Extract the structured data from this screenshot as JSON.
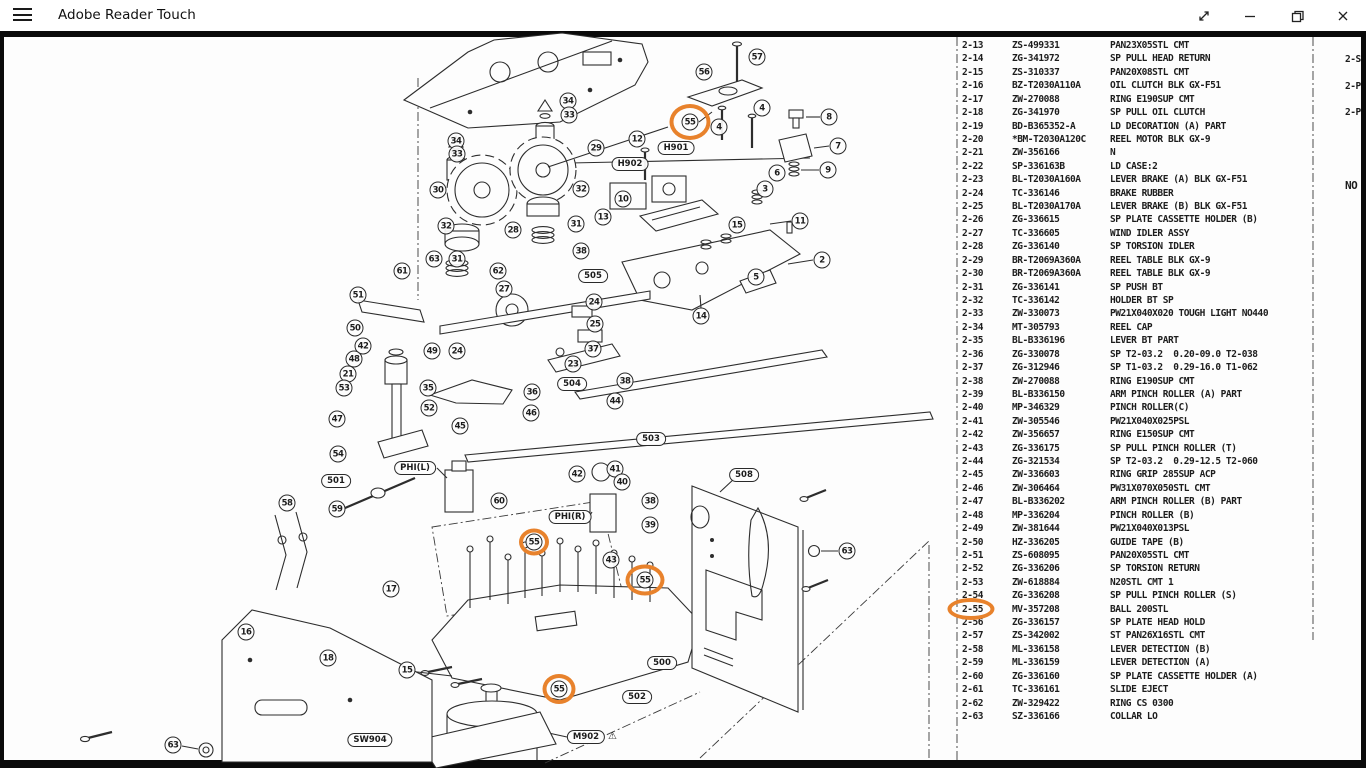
{
  "window": {
    "title": "Adobe Reader Touch"
  },
  "titlebar": {
    "controls": [
      "menu",
      "fullscreen",
      "minimize",
      "restore",
      "close"
    ]
  },
  "page": {
    "parts_list": {
      "layout": {
        "left_x": 962,
        "top_y": 46,
        "row_height": 13.42,
        "ref_dx": 0,
        "part_dx": 50,
        "desc_dx": 148
      },
      "partial_top_row": {
        "ref": "2-12",
        "part": "ZS-366165",
        "desc": "SP PAN26X05STL CMT",
        "y": 33
      },
      "rows": [
        {
          "ref": "2-13",
          "part": "ZS-499331",
          "desc": "PAN23X05STL CMT"
        },
        {
          "ref": "2-14",
          "part": "ZG-341972",
          "desc": "SP PULL HEAD RETURN"
        },
        {
          "ref": "2-15",
          "part": "ZS-310337",
          "desc": "PAN20X08STL CMT"
        },
        {
          "ref": "2-16",
          "part": "BZ-T2030A110A",
          "desc": "OIL CLUTCH BLK GX-F51"
        },
        {
          "ref": "2-17",
          "part": "ZW-270088",
          "desc": "RING E190SUP CMT"
        },
        {
          "ref": "2-18",
          "part": "ZG-341970",
          "desc": "SP PULL OIL CLUTCH"
        },
        {
          "ref": "2-19",
          "part": "BD-B365352-A",
          "desc": "LD DECORATION (A) PART"
        },
        {
          "ref": "2-20",
          "part": "*BM-T2030A120C",
          "desc": "REEL MOTOR BLK GX-9"
        },
        {
          "ref": "2-21",
          "part": "ZW-356166",
          "desc": "N"
        },
        {
          "ref": "2-22",
          "part": "SP-336163B",
          "desc": "LD CASE:2"
        },
        {
          "ref": "2-23",
          "part": "BL-T2030A160A",
          "desc": "LEVER BRAKE (A) BLK GX-F51"
        },
        {
          "ref": "2-24",
          "part": "TC-336146",
          "desc": "BRAKE RUBBER"
        },
        {
          "ref": "2-25",
          "part": "BL-T2030A170A",
          "desc": "LEVER BRAKE (B) BLK GX-F51"
        },
        {
          "ref": "2-26",
          "part": "ZG-336615",
          "desc": "SP PLATE CASSETTE HOLDER (B)"
        },
        {
          "ref": "2-27",
          "part": "TC-336605",
          "desc": "WIND IDLER ASSY"
        },
        {
          "ref": "2-28",
          "part": "ZG-336140",
          "desc": "SP TORSION IDLER"
        },
        {
          "ref": "2-29",
          "part": "BR-T2069A360A",
          "desc": "REEL TABLE BLK GX-9"
        },
        {
          "ref": "2-30",
          "part": "BR-T2069A360A",
          "desc": "REEL TABLE BLK GX-9"
        },
        {
          "ref": "2-31",
          "part": "ZG-336141",
          "desc": "SP PUSH BT"
        },
        {
          "ref": "2-32",
          "part": "TC-336142",
          "desc": "HOLDER BT SP"
        },
        {
          "ref": "2-33",
          "part": "ZW-330073",
          "desc": "PW21X040X020 TOUGH LIGHT NO440"
        },
        {
          "ref": "2-34",
          "part": "MT-305793",
          "desc": "REEL CAP"
        },
        {
          "ref": "2-35",
          "part": "BL-B336196",
          "desc": "LEVER BT PART"
        },
        {
          "ref": "2-36",
          "part": "ZG-330078",
          "desc": "SP T2-03.2  0.20-09.0 T2-038"
        },
        {
          "ref": "2-37",
          "part": "ZG-312946",
          "desc": "SP T1-03.2  0.29-16.0 T1-062"
        },
        {
          "ref": "2-38",
          "part": "ZW-270088",
          "desc": "RING E190SUP CMT"
        },
        {
          "ref": "2-39",
          "part": "BL-B336150",
          "desc": "ARM PINCH ROLLER (A) PART"
        },
        {
          "ref": "2-40",
          "part": "MP-346329",
          "desc": "PINCH ROLLER(C)"
        },
        {
          "ref": "2-41",
          "part": "ZW-305546",
          "desc": "PW21X040X025PSL"
        },
        {
          "ref": "2-42",
          "part": "ZW-356657",
          "desc": "RING E150SUP CMT"
        },
        {
          "ref": "2-43",
          "part": "ZG-336175",
          "desc": "SP PULL PINCH ROLLER (T)"
        },
        {
          "ref": "2-44",
          "part": "ZG-321534",
          "desc": "SP T2-03.2  0.29-12.5 T2-060"
        },
        {
          "ref": "2-45",
          "part": "ZW-336603",
          "desc": "RING GRIP 285SUP ACP"
        },
        {
          "ref": "2-46",
          "part": "ZW-306464",
          "desc": "PW31X070X050STL CMT"
        },
        {
          "ref": "2-47",
          "part": "BL-B336202",
          "desc": "ARM PINCH ROLLER (B) PART"
        },
        {
          "ref": "2-48",
          "part": "MP-336204",
          "desc": "PINCH ROLLER (B)"
        },
        {
          "ref": "2-49",
          "part": "ZW-381644",
          "desc": "PW21X040X013PSL"
        },
        {
          "ref": "2-50",
          "part": "HZ-336205",
          "desc": "GUIDE TAPE (B)"
        },
        {
          "ref": "2-51",
          "part": "ZS-608095",
          "desc": "PAN20X05STL CMT"
        },
        {
          "ref": "2-52",
          "part": "ZG-336206",
          "desc": "SP TORSION RETURN"
        },
        {
          "ref": "2-53",
          "part": "ZW-618884",
          "desc": "N20STL CMT 1"
        },
        {
          "ref": "2-54",
          "part": "ZG-336208",
          "desc": "SP PULL PINCH ROLLER (S)"
        },
        {
          "ref": "2-55",
          "part": "MV-357208",
          "desc": "BALL 200STL"
        },
        {
          "ref": "2-56",
          "part": "ZG-336157",
          "desc": "SP PLATE HEAD HOLD"
        },
        {
          "ref": "2-57",
          "part": "ZS-342002",
          "desc": "ST PAN26X16STL CMT"
        },
        {
          "ref": "2-58",
          "part": "ML-336158",
          "desc": "LEVER DETECTION (B)"
        },
        {
          "ref": "2-59",
          "part": "ML-336159",
          "desc": "LEVER DETECTION (A)"
        },
        {
          "ref": "2-60",
          "part": "ZG-336160",
          "desc": "SP PLATE CASSETTE HOLDER (A)"
        },
        {
          "ref": "2-61",
          "part": "TC-336161",
          "desc": "SLIDE EJECT"
        },
        {
          "ref": "2-62",
          "part": "ZW-329422",
          "desc": "RING CS 0300"
        },
        {
          "ref": "2-63",
          "part": "SZ-336166",
          "desc": "COLLAR LO"
        }
      ],
      "side_fragments": [
        {
          "text": "2-S",
          "x": 1345,
          "y": 60
        },
        {
          "text": "2-P",
          "x": 1345,
          "y": 87
        },
        {
          "text": "2-P",
          "x": 1345,
          "y": 113
        },
        {
          "text": "NO",
          "x": 1345,
          "y": 185
        }
      ]
    },
    "diagram": {
      "callouts": [
        {
          "n": "57",
          "x": 757,
          "y": 57
        },
        {
          "n": "56",
          "x": 704,
          "y": 72
        },
        {
          "n": "55",
          "x": 690,
          "y": 122
        },
        {
          "n": "4",
          "x": 762,
          "y": 108
        },
        {
          "n": "4",
          "x": 719,
          "y": 127
        },
        {
          "n": "8",
          "x": 829,
          "y": 117
        },
        {
          "n": "7",
          "x": 838,
          "y": 146
        },
        {
          "n": "9",
          "x": 828,
          "y": 170
        },
        {
          "n": "12",
          "x": 637,
          "y": 139
        },
        {
          "n": "29",
          "x": 596,
          "y": 148
        },
        {
          "n": "34",
          "x": 568,
          "y": 101
        },
        {
          "n": "33",
          "x": 569,
          "y": 115
        },
        {
          "n": "34",
          "x": 456,
          "y": 141
        },
        {
          "n": "33",
          "x": 457,
          "y": 154
        },
        {
          "n": "30",
          "x": 438,
          "y": 190
        },
        {
          "n": "32",
          "x": 581,
          "y": 189
        },
        {
          "n": "31",
          "x": 576,
          "y": 224
        },
        {
          "n": "28",
          "x": 513,
          "y": 230
        },
        {
          "n": "32",
          "x": 446,
          "y": 226
        },
        {
          "n": "31",
          "x": 457,
          "y": 259
        },
        {
          "n": "38",
          "x": 581,
          "y": 251
        },
        {
          "n": "62",
          "x": 498,
          "y": 271
        },
        {
          "n": "61",
          "x": 402,
          "y": 271
        },
        {
          "n": "63",
          "x": 434,
          "y": 259
        },
        {
          "n": "27",
          "x": 504,
          "y": 289
        },
        {
          "n": "51",
          "x": 358,
          "y": 295
        },
        {
          "n": "10",
          "x": 623,
          "y": 199
        },
        {
          "n": "13",
          "x": 603,
          "y": 217
        },
        {
          "n": "6",
          "x": 777,
          "y": 173
        },
        {
          "n": "3",
          "x": 765,
          "y": 189
        },
        {
          "n": "15",
          "x": 737,
          "y": 225
        },
        {
          "n": "11",
          "x": 800,
          "y": 221
        },
        {
          "n": "2",
          "x": 822,
          "y": 260
        },
        {
          "n": "5",
          "x": 756,
          "y": 277
        },
        {
          "n": "14",
          "x": 701,
          "y": 316
        },
        {
          "n": "50",
          "x": 355,
          "y": 328
        },
        {
          "n": "42",
          "x": 363,
          "y": 346
        },
        {
          "n": "49",
          "x": 432,
          "y": 351
        },
        {
          "n": "48",
          "x": 354,
          "y": 359
        },
        {
          "n": "21",
          "x": 348,
          "y": 374
        },
        {
          "n": "53",
          "x": 344,
          "y": 388
        },
        {
          "n": "47",
          "x": 337,
          "y": 419
        },
        {
          "n": "54",
          "x": 338,
          "y": 454
        },
        {
          "n": "59",
          "x": 337,
          "y": 509
        },
        {
          "n": "35",
          "x": 428,
          "y": 388
        },
        {
          "n": "52",
          "x": 429,
          "y": 408
        },
        {
          "n": "24",
          "x": 457,
          "y": 351
        },
        {
          "n": "24",
          "x": 594,
          "y": 302
        },
        {
          "n": "25",
          "x": 595,
          "y": 324
        },
        {
          "n": "37",
          "x": 593,
          "y": 349
        },
        {
          "n": "23",
          "x": 573,
          "y": 364
        },
        {
          "n": "38",
          "x": 625,
          "y": 381
        },
        {
          "n": "36",
          "x": 532,
          "y": 392
        },
        {
          "n": "44",
          "x": 615,
          "y": 401
        },
        {
          "n": "46",
          "x": 531,
          "y": 413
        },
        {
          "n": "45",
          "x": 460,
          "y": 426
        },
        {
          "n": "60",
          "x": 499,
          "y": 501
        },
        {
          "n": "42",
          "x": 577,
          "y": 474
        },
        {
          "n": "41",
          "x": 615,
          "y": 469
        },
        {
          "n": "40",
          "x": 622,
          "y": 482
        },
        {
          "n": "38",
          "x": 650,
          "y": 501
        },
        {
          "n": "39",
          "x": 650,
          "y": 525
        },
        {
          "n": "43",
          "x": 611,
          "y": 560
        },
        {
          "n": "55",
          "x": 534,
          "y": 542
        },
        {
          "n": "55",
          "x": 645,
          "y": 580
        },
        {
          "n": "58",
          "x": 287,
          "y": 503
        },
        {
          "n": "17",
          "x": 391,
          "y": 589
        },
        {
          "n": "16",
          "x": 246,
          "y": 632
        },
        {
          "n": "18",
          "x": 328,
          "y": 658
        },
        {
          "n": "15",
          "x": 407,
          "y": 670
        },
        {
          "n": "55",
          "x": 559,
          "y": 689
        },
        {
          "n": "63",
          "x": 847,
          "y": 551
        },
        {
          "n": "63",
          "x": 173,
          "y": 745
        }
      ],
      "labels": [
        {
          "text": "H901",
          "x": 676,
          "y": 148
        },
        {
          "text": "H902",
          "x": 630,
          "y": 164
        },
        {
          "text": "505",
          "x": 593,
          "y": 276
        },
        {
          "text": "501",
          "x": 336,
          "y": 481
        },
        {
          "text": "PHI(L)",
          "x": 415,
          "y": 468
        },
        {
          "text": "504",
          "x": 572,
          "y": 384
        },
        {
          "text": "503",
          "x": 651,
          "y": 439
        },
        {
          "text": "PHI(R)",
          "x": 570,
          "y": 517
        },
        {
          "text": "508",
          "x": 744,
          "y": 475
        },
        {
          "text": "500",
          "x": 662,
          "y": 663
        },
        {
          "text": "502",
          "x": 637,
          "y": 697
        },
        {
          "text": "SW904",
          "x": 370,
          "y": 740
        },
        {
          "text": "M902",
          "x": 586,
          "y": 737,
          "warning": true
        }
      ],
      "warning_glyph": "⚠"
    },
    "annotations": {
      "color": "#E8822C",
      "ellipses": [
        {
          "x": 690,
          "y": 122,
          "w": 41,
          "h": 36
        },
        {
          "x": 534,
          "y": 542,
          "w": 30,
          "h": 27
        },
        {
          "x": 645,
          "y": 580,
          "w": 39,
          "h": 31
        },
        {
          "x": 559,
          "y": 689,
          "w": 33,
          "h": 30
        },
        {
          "x": 971,
          "y": 609,
          "w": 47,
          "h": 22
        }
      ]
    }
  }
}
